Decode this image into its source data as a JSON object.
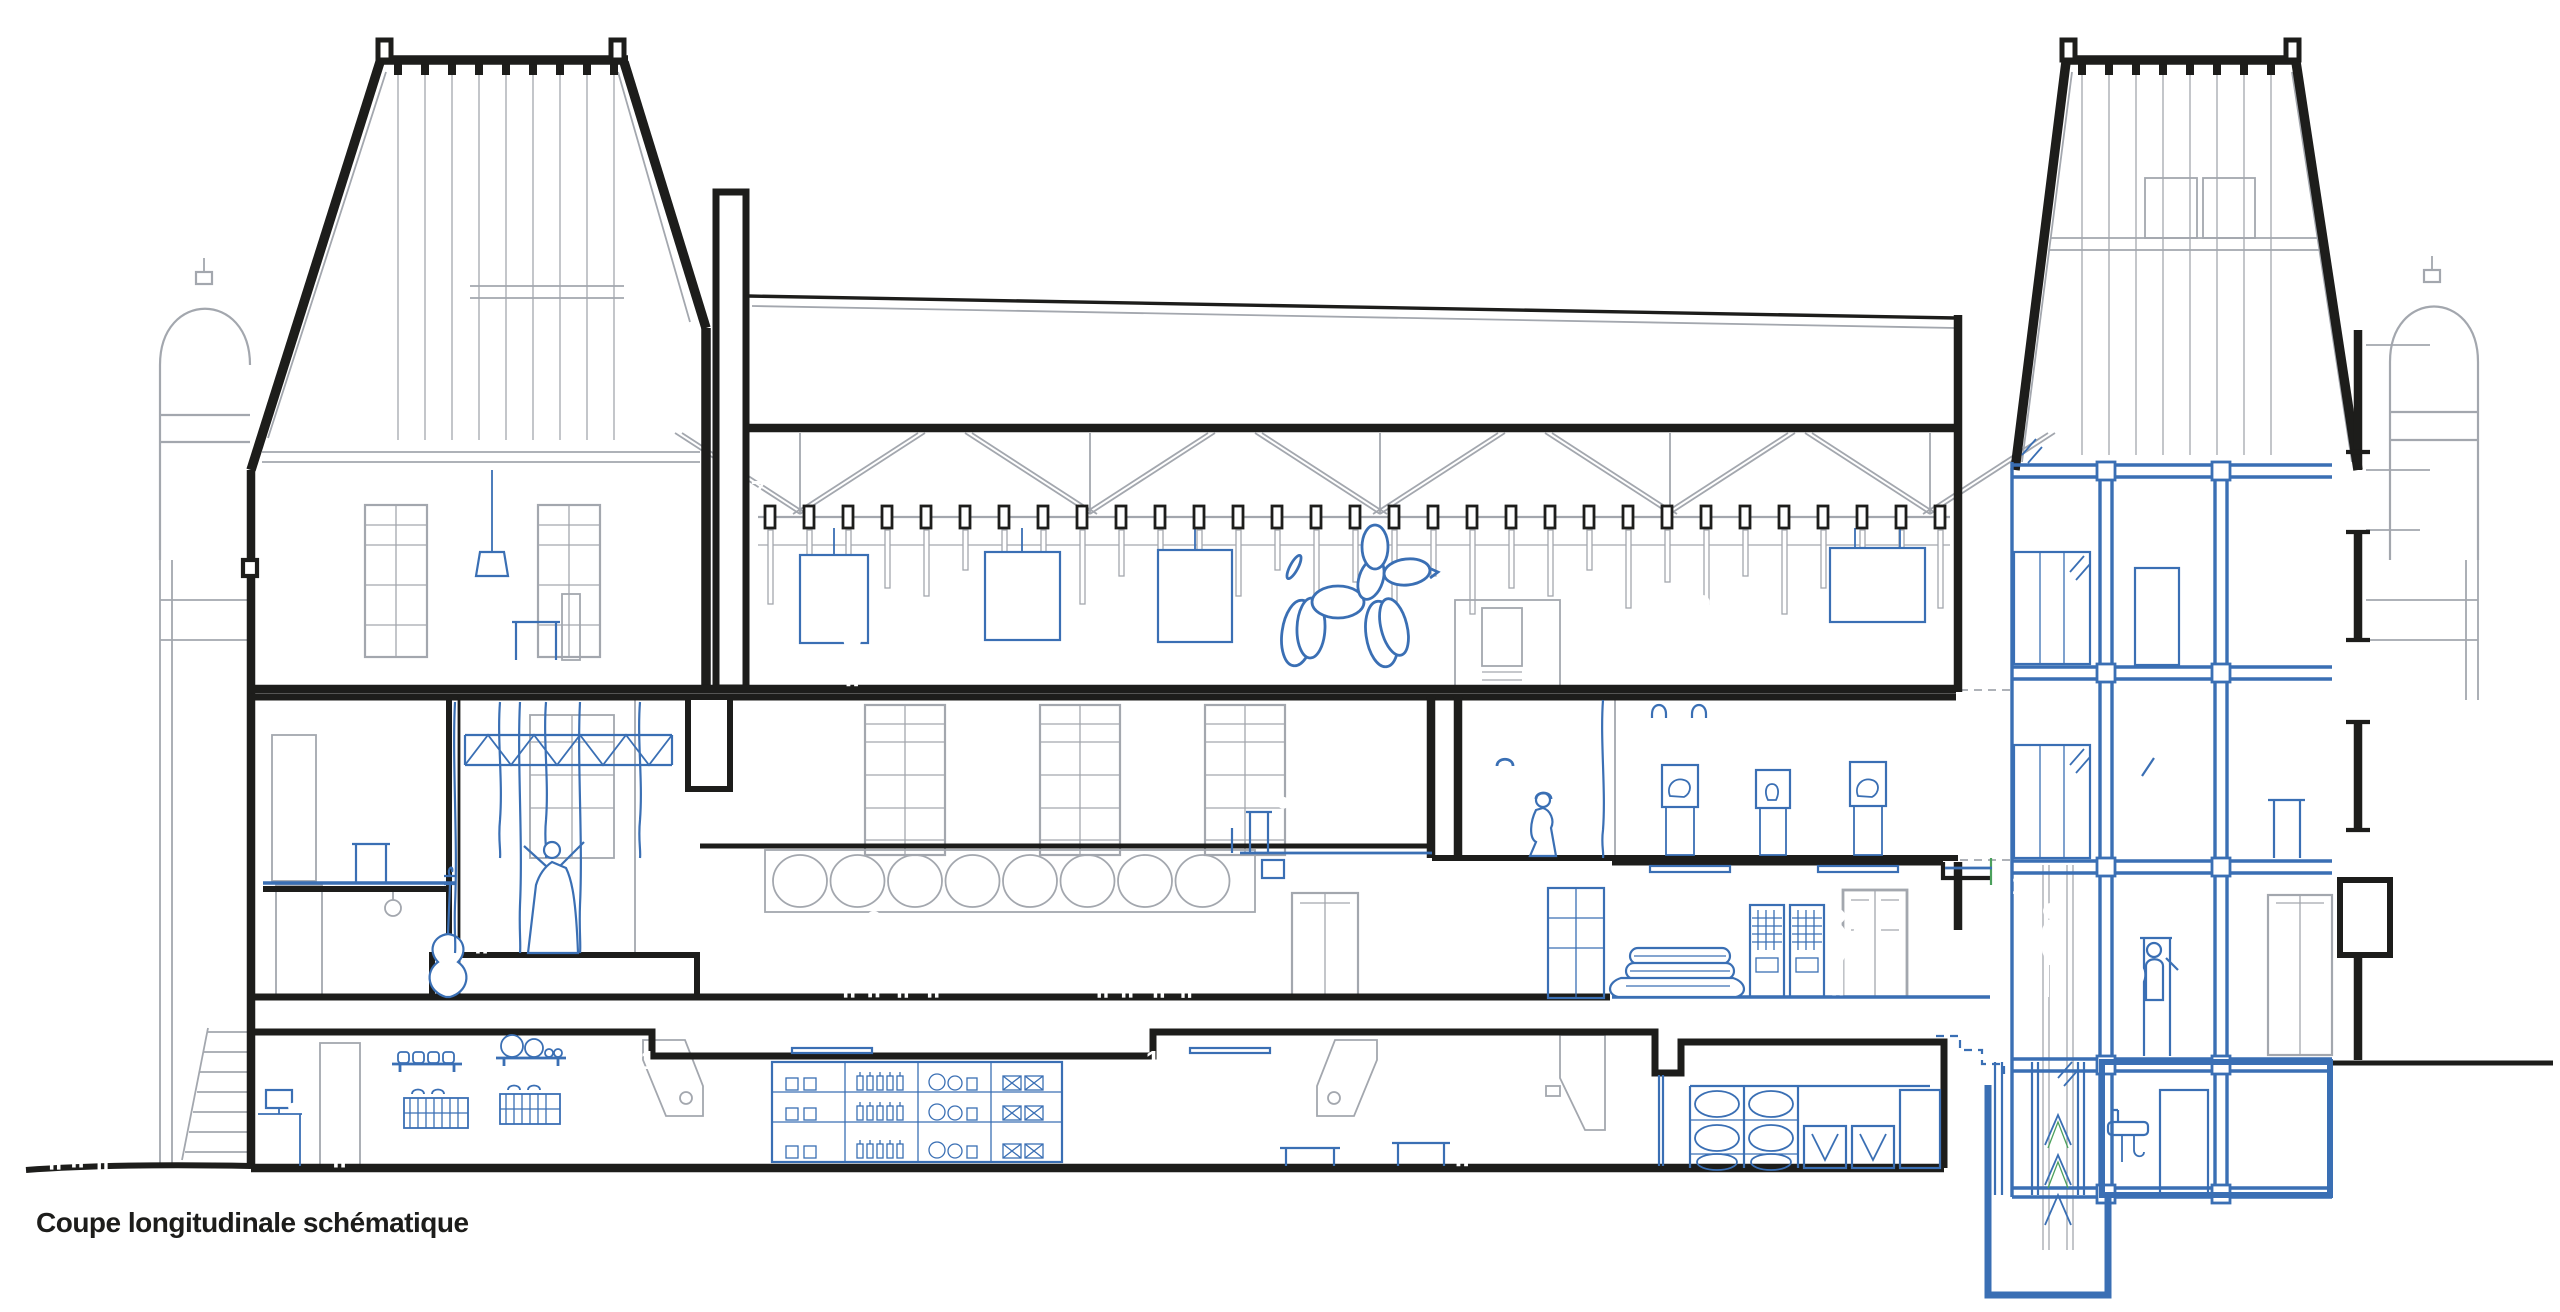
{
  "caption": {
    "text": "Coupe longitudinale schématique"
  },
  "colors": {
    "ink": "#1d1d1b",
    "detail_gray": "#a3a7ae",
    "light_gray": "#c9ccd1",
    "accent_blue": "#3a6fb4",
    "green": "#4ba05c",
    "figure_gray": "#9ba0a8",
    "marker_bg": "#211d1a",
    "marker_text": "#ffffff",
    "paper": "#ffffff"
  },
  "markers": [
    {
      "label": "8",
      "x": 675,
      "y": 490
    },
    {
      "label": "7",
      "x": 758,
      "y": 490
    },
    {
      "label": "5",
      "x": 422,
      "y": 721
    },
    {
      "label": "4",
      "x": 487,
      "y": 721
    },
    {
      "label": "3",
      "x": 762,
      "y": 721
    },
    {
      "label": "6",
      "x": 1405,
      "y": 722
    },
    {
      "label": "12",
      "x": 1478,
      "y": 722
    },
    {
      "label": "11",
      "x": 1637,
      "y": 720
    },
    {
      "label": "5",
      "x": 414,
      "y": 930
    },
    {
      "label": "10",
      "x": 1634,
      "y": 882
    },
    {
      "label": "13",
      "x": 2026,
      "y": 885
    },
    {
      "label": "9",
      "x": 2138,
      "y": 975
    },
    {
      "label": "16",
      "x": 2170,
      "y": 512
    },
    {
      "label": "1",
      "x": 648,
      "y": 1060
    },
    {
      "label": "1",
      "x": 1153,
      "y": 1060
    },
    {
      "label": "2",
      "x": 1634,
      "y": 1057
    },
    {
      "label": "15",
      "x": 1925,
      "y": 1072
    },
    {
      "label": "16",
      "x": 2140,
      "y": 1102
    },
    {
      "label": "14",
      "x": 2312,
      "y": 1102
    }
  ]
}
